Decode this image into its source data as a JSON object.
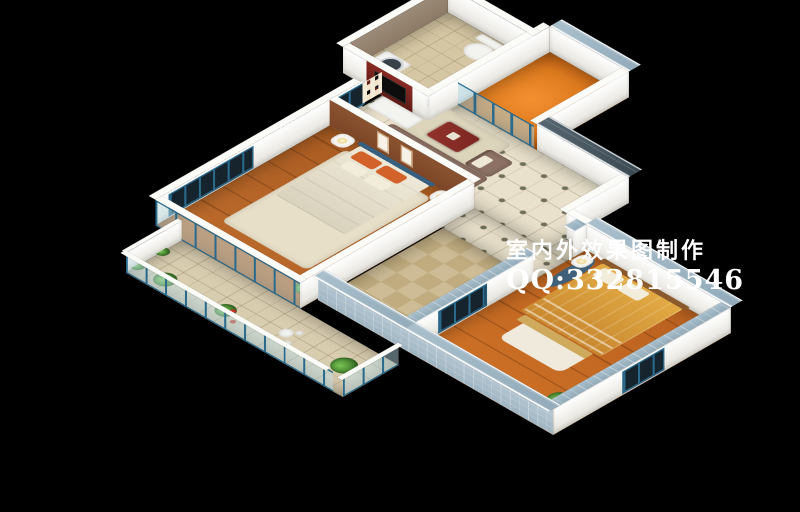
{
  "watermark": {
    "line1": "室内外效果图制作",
    "line2": "QQ:332815546"
  },
  "scene": {
    "type": "3d-isometric-apartment-floor-plan-render",
    "rooms": [
      "living-room",
      "master-bedroom",
      "balcony",
      "bathroom",
      "laundry-balcony",
      "kitchen",
      "second-bedroom",
      "corridor"
    ]
  },
  "palette": {
    "background": "#000000",
    "wall_white": "#f4f2ec",
    "wall_taupe": "#8d7a66",
    "wall_brown": "#7c4526",
    "frame_teal": "#2a6a8c",
    "glass_tint": "rgba(190,225,235,0.45)",
    "cap_slate": "#47565f",
    "cap_blue": "#a9bfcc",
    "tile_living": "#e9e1cb",
    "tile_diamond": "#6f6f5a",
    "wood_master": "#a85a20",
    "wood_bedroom2": "#b86020",
    "floor_orange": "#dd7a1e",
    "floor_bath": "#d6c7a4",
    "floor_kitchen": "#cdbc96",
    "floor_balcony": "#d9cdb0",
    "sofa": "#8c7164",
    "coffee_table": "#7c2622",
    "bed_sheet": "#e8e1cd",
    "pillow_orange": "#d2622a",
    "headboard_blue": "#35607f",
    "bed2_spread": "#dca23e",
    "tv_black": "#0d0d0d",
    "appliance_white": "#f3f3f0",
    "plant_green": "#3f7d2a",
    "accent_red": "#b6322a",
    "text_white": "#ffffff"
  }
}
